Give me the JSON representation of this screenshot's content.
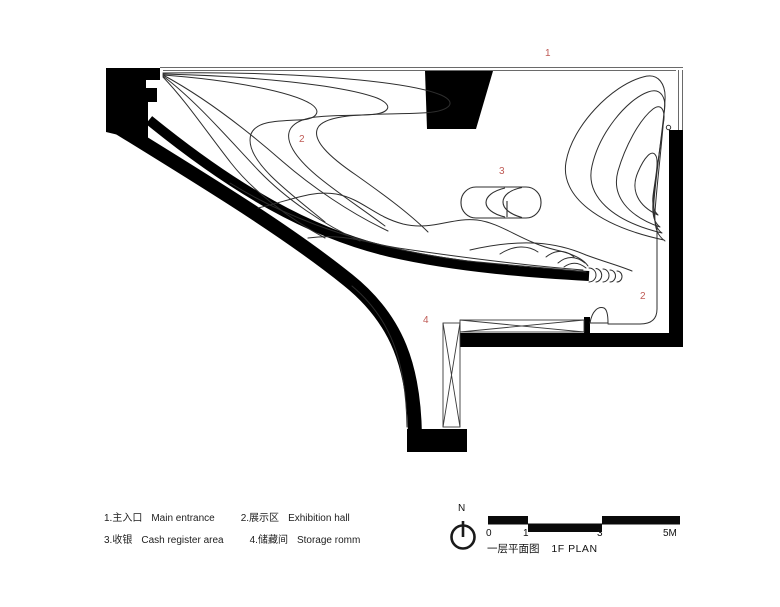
{
  "drawing": {
    "title_zh": "一层平面图",
    "title_en": "1F PLAN",
    "north_label": "N",
    "marker_color": "#bf5a55",
    "wall_color": "#000000",
    "area_markers": [
      "1",
      "2",
      "3",
      "2",
      "4"
    ],
    "legend": {
      "items": [
        {
          "zh": "1.主入口",
          "en": "Main entrance"
        },
        {
          "zh": "2.展示区",
          "en": "Exhibition hall"
        },
        {
          "zh": "3.收银",
          "en": "Cash register area"
        },
        {
          "zh": "4.储藏间",
          "en": "Storage romm"
        }
      ]
    },
    "scale_bar": {
      "tick_labels": [
        "0",
        "1",
        "3",
        "5M"
      ]
    }
  }
}
